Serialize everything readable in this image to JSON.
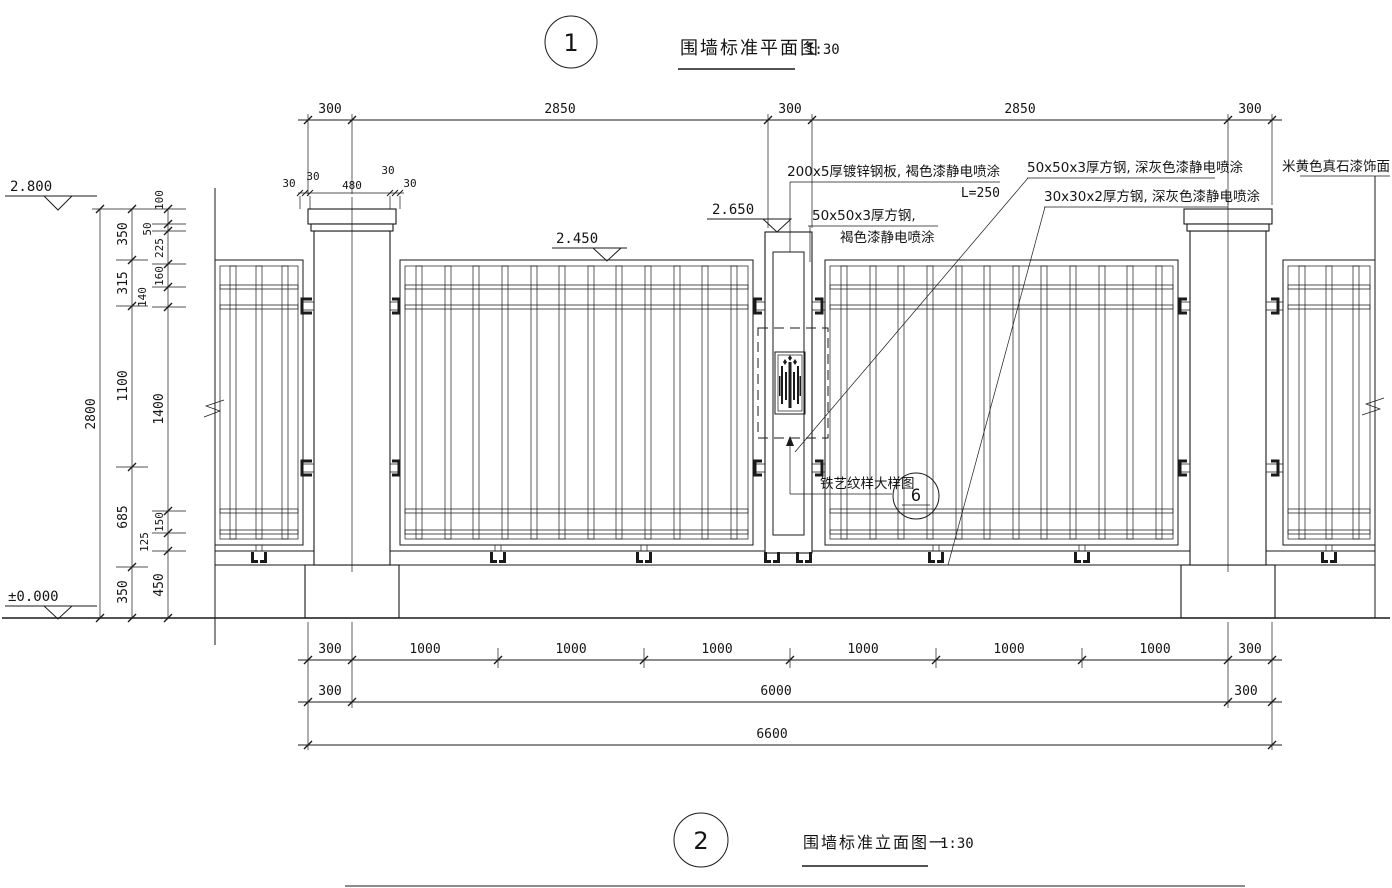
{
  "sheet": {
    "views": [
      {
        "number": "1",
        "title": "围墙标准平面图",
        "scale": "1:30"
      },
      {
        "number": "2",
        "title": "围墙标准立面图一",
        "scale": "1:30"
      }
    ]
  },
  "levels": {
    "wall_top": "2.800",
    "panel_top": "2.450",
    "gate_post_top": "2.650",
    "ground": "±0.000"
  },
  "notes": {
    "plate": "200x5厚镀锌钢板, 褐色漆静电喷涂",
    "plate_len": "L=250",
    "tube50_grey": "50x50x3厚方钢, 深灰色漆静电喷涂",
    "tube30_grey": "30x30x2厚方钢, 深灰色漆静电喷涂",
    "tube50_brown_l1": "50x50x3厚方钢,",
    "tube50_brown_l2": "褐色漆静电喷涂",
    "stone": "米黄色真石漆饰面",
    "iron_detail": "铁艺纹样大样图",
    "detail_no": "6"
  },
  "dims": {
    "top": [
      "300",
      "2850",
      "300",
      "2850",
      "300"
    ],
    "cap": [
      "30",
      "30",
      "480",
      "30",
      "30"
    ],
    "row1": [
      "300",
      "1000",
      "1000",
      "1000",
      "1000",
      "1000",
      "1000",
      "300"
    ],
    "row2": [
      "300",
      "6000",
      "300"
    ],
    "row3": [
      "6600"
    ],
    "total_h": "2800",
    "chain_b": [
      "350",
      "315",
      "1100",
      "685",
      "350"
    ],
    "chain_c": [
      "100",
      "50",
      "225",
      "160",
      "140",
      "1400",
      "150",
      "125",
      "450"
    ]
  }
}
